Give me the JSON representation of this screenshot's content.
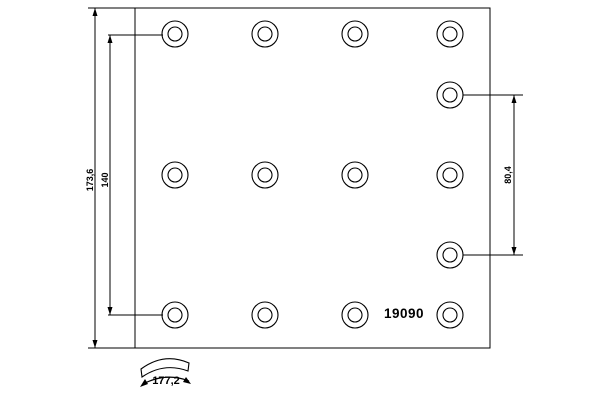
{
  "part": {
    "number": "19090"
  },
  "dimensions": {
    "height_total": "173,6",
    "hole_span_vertical": "140",
    "hole_span_right": "80,4",
    "arc_width": "177,2"
  },
  "drawing": {
    "colors": {
      "line": "#000000",
      "background": "#ffffff"
    },
    "plate": {
      "x": 135,
      "y": 8,
      "w": 355,
      "h": 340
    },
    "hole_outer_r": 13,
    "hole_inner_r": 7,
    "holes": [
      [
        175,
        34
      ],
      [
        265,
        34
      ],
      [
        355,
        34
      ],
      [
        450,
        34
      ],
      [
        450,
        95
      ],
      [
        175,
        175
      ],
      [
        265,
        175
      ],
      [
        355,
        175
      ],
      [
        450,
        175
      ],
      [
        450,
        255
      ],
      [
        175,
        315
      ],
      [
        265,
        315
      ],
      [
        355,
        315
      ],
      [
        450,
        315
      ]
    ],
    "lines": [
      [
        88,
        8,
        136,
        8
      ],
      [
        88,
        348,
        136,
        348
      ],
      [
        95,
        8,
        95,
        348
      ],
      [
        110,
        35,
        110,
        315
      ],
      [
        108,
        35,
        163,
        35
      ],
      [
        108,
        315,
        163,
        315
      ],
      [
        463,
        95,
        523,
        95
      ],
      [
        463,
        255,
        523,
        255
      ],
      [
        514,
        95,
        514,
        255
      ]
    ],
    "arrow_ticks": [
      [
        95,
        8,
        "up"
      ],
      [
        95,
        348,
        "down"
      ],
      [
        110,
        35,
        "up"
      ],
      [
        110,
        315,
        "down"
      ],
      [
        514,
        95,
        "up"
      ],
      [
        514,
        255,
        "down"
      ]
    ],
    "arc_band_path": "M 141 369 Q 164 352 189 363 L 188 371 Q 164 362 142 377 Z",
    "arc_arrow_path": "M 143 384 Q 166 372 189 381",
    "arc_arrowheads": [
      "140,387 145,379 148,384",
      "191,384 186,377 183,382"
    ]
  }
}
